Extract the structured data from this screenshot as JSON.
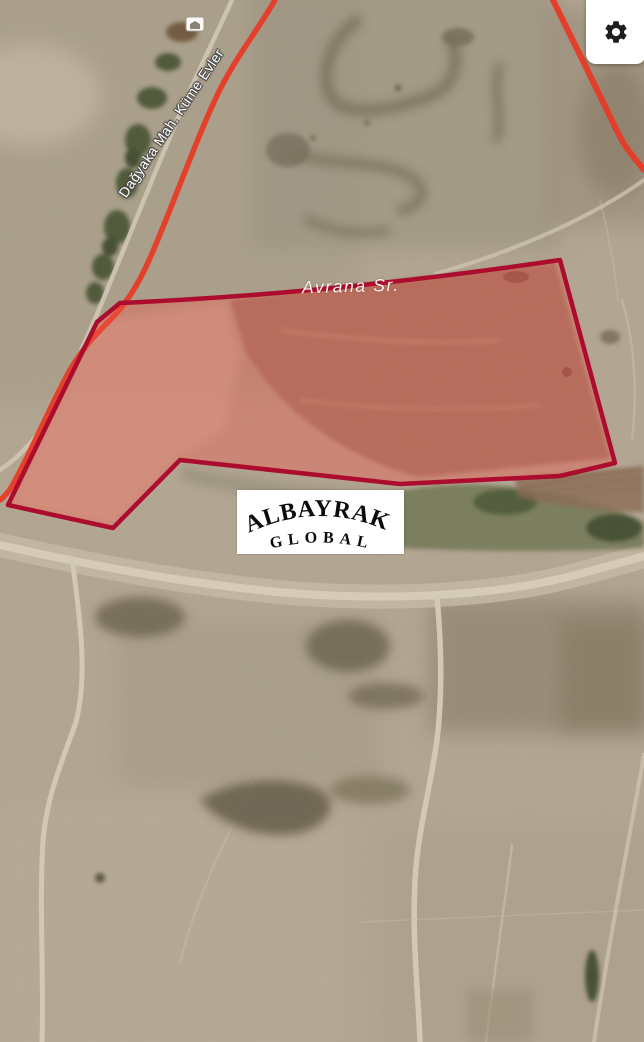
{
  "map": {
    "labels": {
      "road": "Dağyaka Mah. Küme Evler",
      "stream": "Avrana Sr."
    },
    "watermark": {
      "line1": "ALBAYRAK",
      "line2": "GLOBAL"
    },
    "colors": {
      "route": "#e73b27",
      "parcel_border": "#ac0c2d",
      "parcel_fill": "rgba(243,85,73,0.38)"
    }
  },
  "toolbar": {
    "settings_icon": "gear"
  }
}
